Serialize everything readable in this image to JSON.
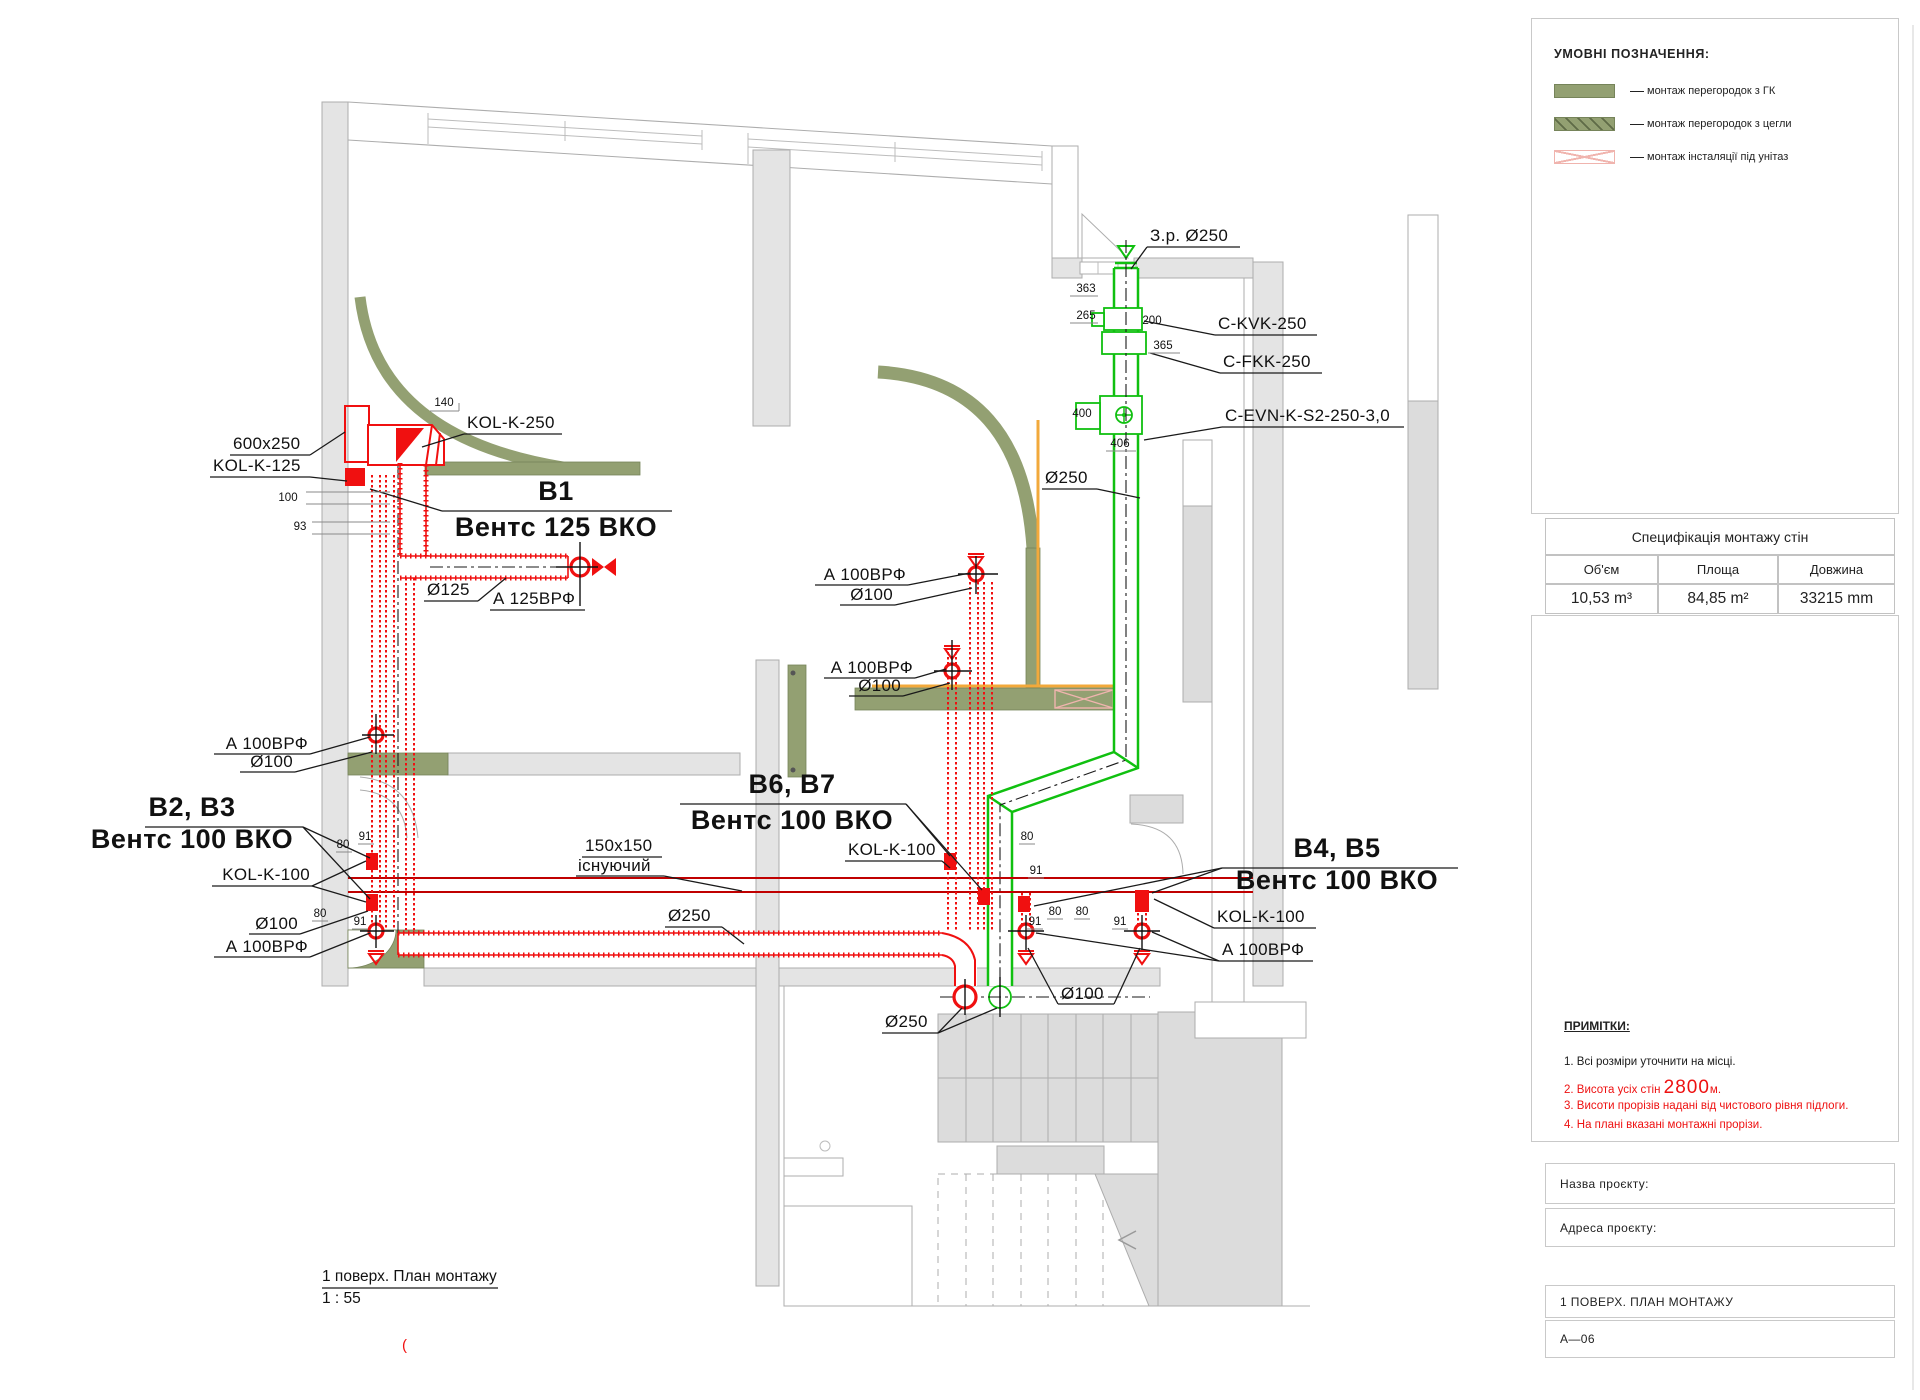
{
  "colors": {
    "accent_red": "#f01010",
    "existing_red": "#c00000",
    "accent_green": "#10c010",
    "olive": "#93a072",
    "orange": "#f2a93b",
    "pink_hatch": "#f0b4ae",
    "wall_gray": "#e4e4e4",
    "note_red": "#ee1111"
  },
  "legend": {
    "title": "УМОВНІ ПОЗНАЧЕННЯ:",
    "items": [
      {
        "swatch": "solid-olive",
        "label": "монтаж перегородок з ГК"
      },
      {
        "swatch": "hatched-olive",
        "label": "монтаж перегородок з цегли"
      },
      {
        "swatch": "crossed-pink",
        "label": "монтаж інсталяції під унітаз"
      }
    ]
  },
  "spec_table": {
    "title": "Специфікація монтажу стін",
    "columns": [
      "Об'єм",
      "Площа",
      "Довжина"
    ],
    "values": [
      "10,53 m³",
      "84,85 m²",
      "33215 mm"
    ]
  },
  "notes": {
    "title": "ПРИМІТКИ:",
    "item1": "1. Всі розміри уточнити на місці.",
    "item2_num": "2.",
    "item2_text": "Висота усіх стін",
    "item2_value": "2800",
    "item2_unit": "м.",
    "item3": "3. Висоти прорізів надані від чистового рівня підлоги.",
    "item4": "4. На плані вказані монтажні прорізи."
  },
  "title_block": {
    "project_name_label": "Назва проєкту:",
    "project_address_label": "Адреса проєкту:",
    "sheet_title": "1 ПОВЕРХ. ПЛАН МОНТАЖУ",
    "sheet_code": "А—06"
  },
  "drawing": {
    "caption": "1 поверх. План монтажу",
    "scale": "1 : 55",
    "stray_mark": "("
  },
  "plan": {
    "green": {
      "zr": "З.р. Ø250",
      "kvk": "C-KVK-250",
      "fkk": "C-FKK-250",
      "evn": "C-EVN-K-S2-250-3,0",
      "d250": "Ø250"
    },
    "b1": {
      "heading": "В1",
      "subtitle": "Вентс 125 ВКО",
      "kol250": "KOL-K-250",
      "size": "600x250",
      "kol125": "KOL-K-125",
      "d125": "Ø125",
      "a125": "А 125ВРФ"
    },
    "b23": {
      "heading": "В2, В3",
      "subtitle": "Вентс 100 ВКО"
    },
    "b67": {
      "heading": "В6, В7",
      "subtitle": "Вентс 100 ВКО"
    },
    "b45": {
      "heading": "В4, В5",
      "subtitle": "Вентс 100 ВКО"
    },
    "labels": {
      "a100": "А 100ВРФ",
      "d100": "Ø100",
      "kol100": "KOL-K-100",
      "d250": "Ø250",
      "existing_size": "150x150",
      "existing": "існуючий"
    },
    "dims": {
      "d363": "363",
      "d265": "265",
      "d200": "200",
      "d365": "365",
      "d400": "400",
      "d406": "406",
      "d140": "140",
      "d100": "100",
      "d93": "93",
      "d80": "80",
      "d91": "91"
    }
  }
}
